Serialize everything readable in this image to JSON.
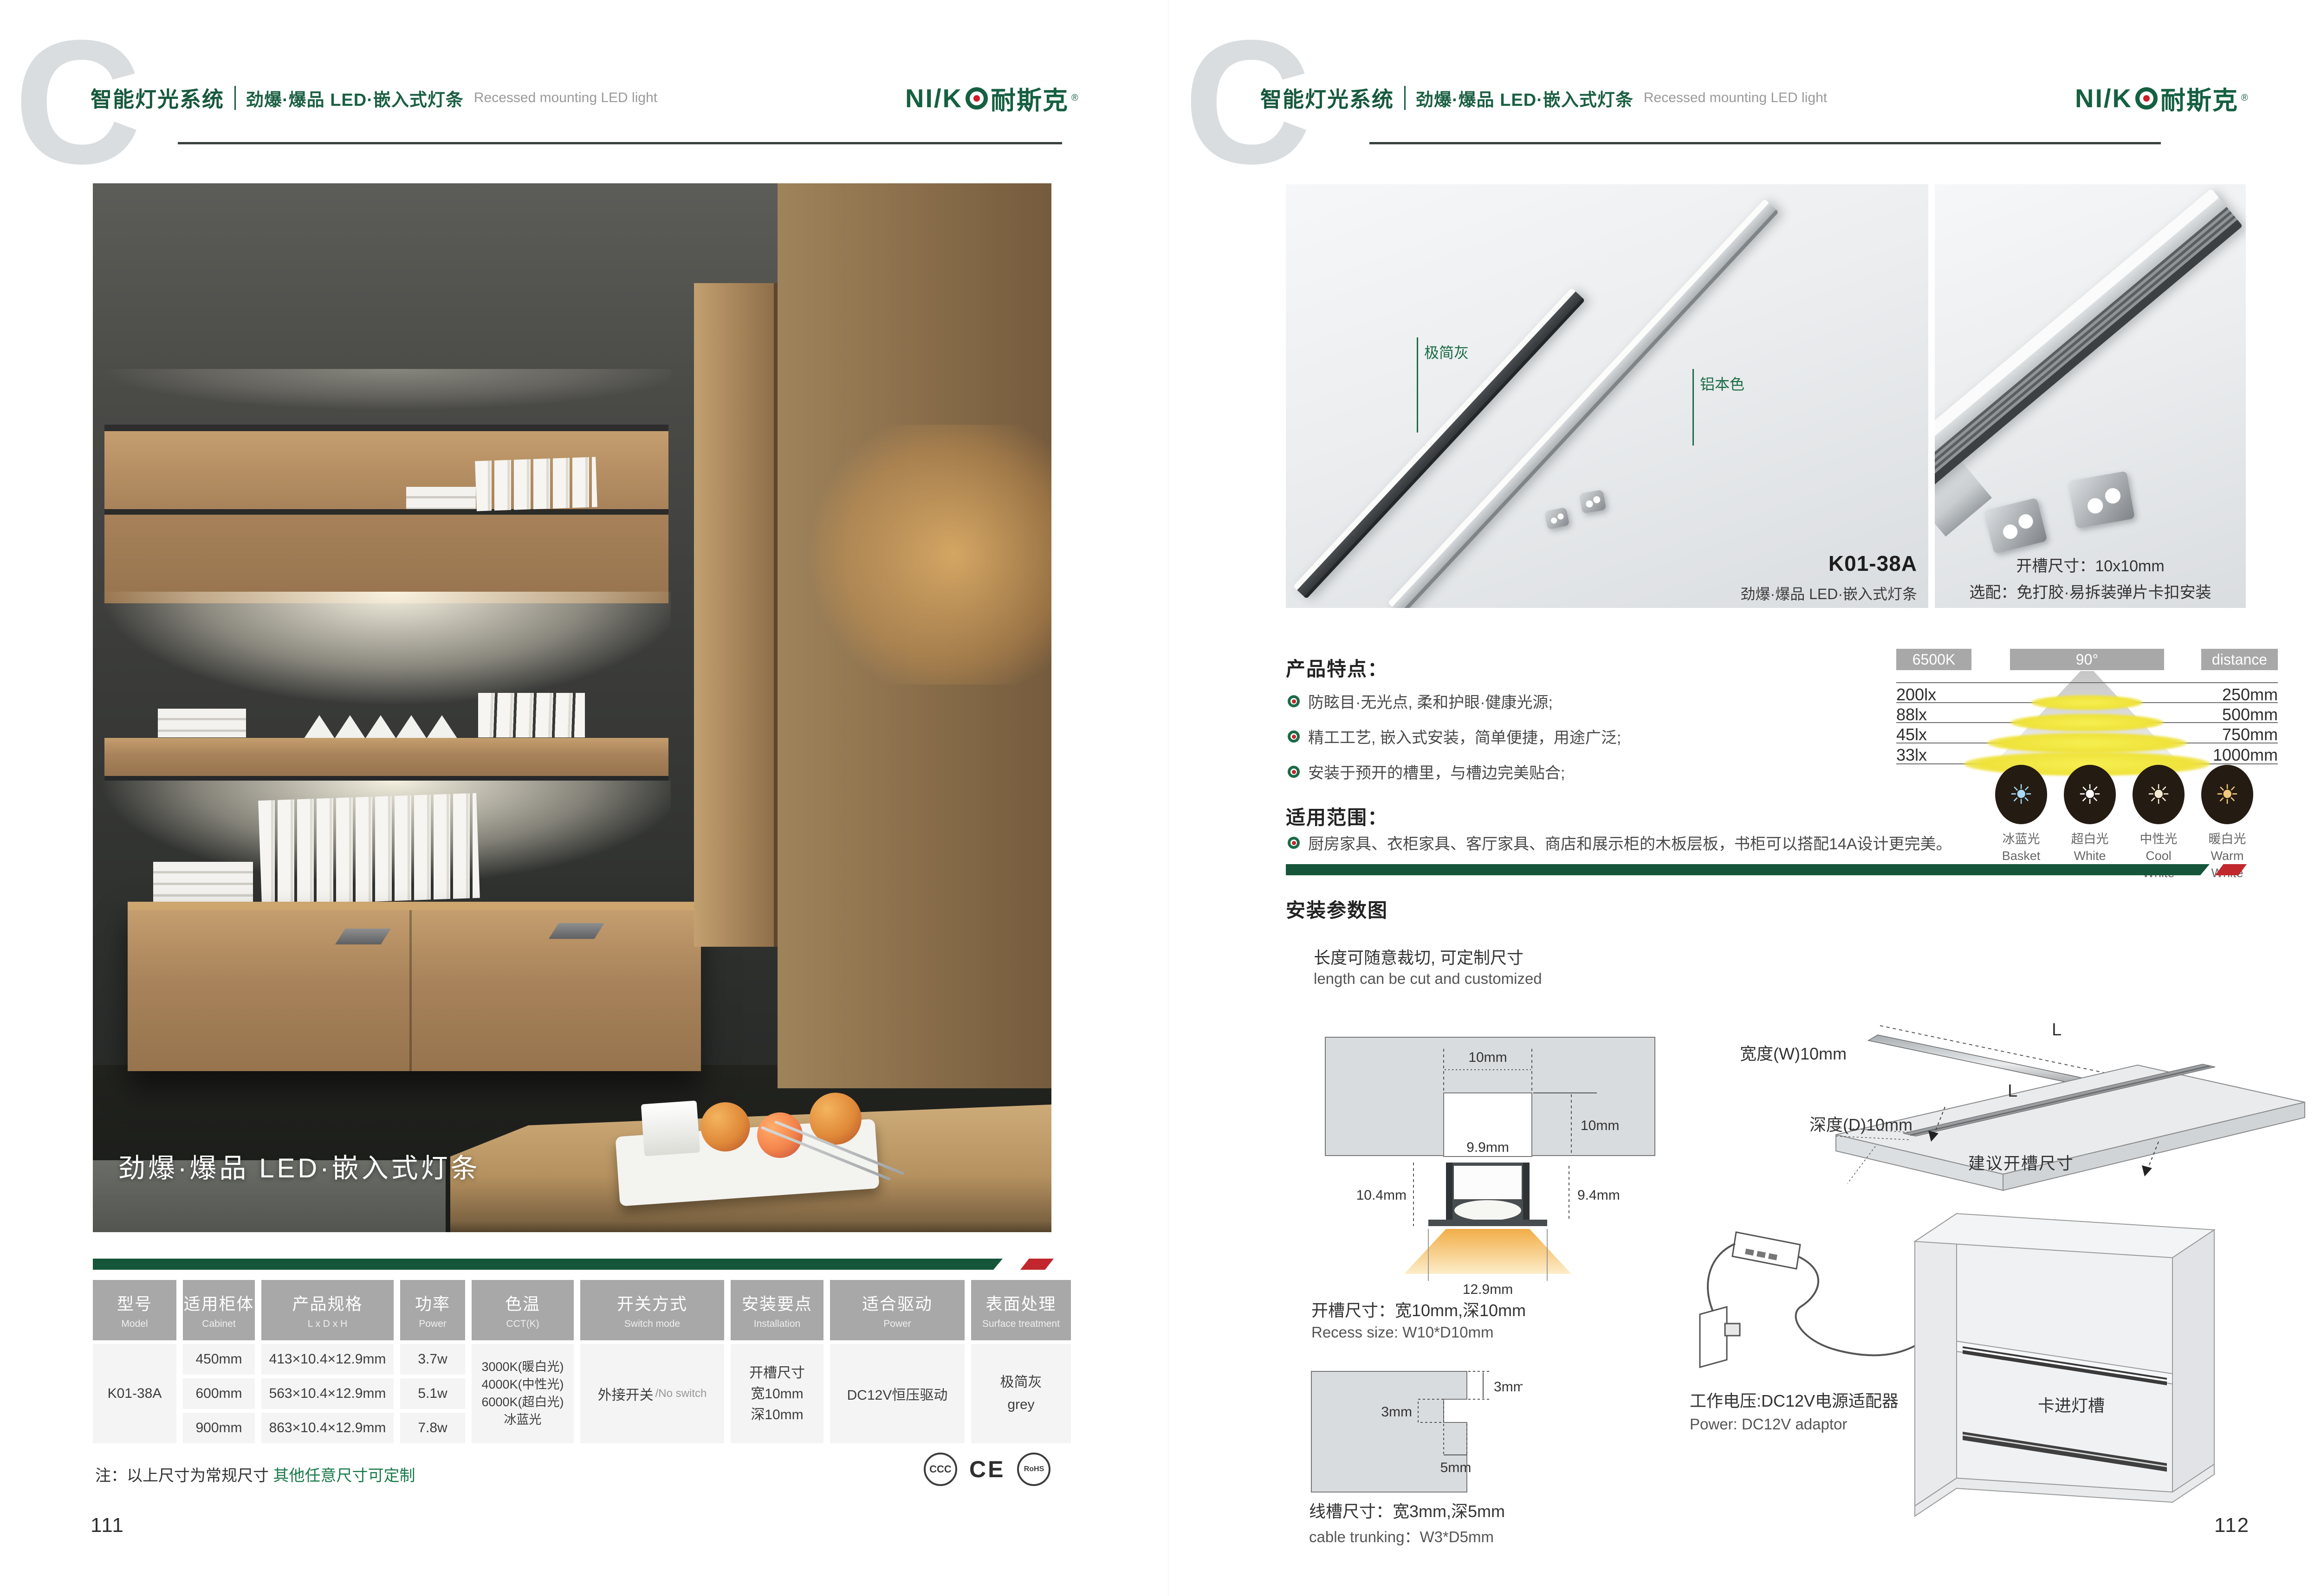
{
  "brand": {
    "latin": "NI/K",
    "cn": "耐斯克",
    "reg": "®"
  },
  "header": {
    "watermark": "C",
    "system": "智能灯光系统",
    "product": "劲爆·爆品  LED·嵌入式灯条",
    "product_en": "Recessed mounting LED light"
  },
  "left_page": {
    "photo_caption": "劲爆·爆品  LED·嵌入式灯条",
    "table": {
      "headers": [
        {
          "cn": "型号",
          "en": "Model"
        },
        {
          "cn": "适用柜体",
          "en": "Cabinet"
        },
        {
          "cn": "产品规格",
          "en": "L x D x H"
        },
        {
          "cn": "功率",
          "en": "Power"
        },
        {
          "cn": "色温",
          "en": "CCT(K)"
        },
        {
          "cn": "开关方式",
          "en": "Switch mode"
        },
        {
          "cn": "安装要点",
          "en": "Installation"
        },
        {
          "cn": "适合驱动",
          "en": "Power"
        },
        {
          "cn": "表面处理",
          "en": "Surface treatment"
        }
      ],
      "model": "K01-38A",
      "rows": [
        {
          "cabinet": "450mm",
          "spec": "413×10.4×12.9mm",
          "power": "3.7w"
        },
        {
          "cabinet": "600mm",
          "spec": "563×10.4×12.9mm",
          "power": "5.1w"
        },
        {
          "cabinet": "900mm",
          "spec": "863×10.4×12.9mm",
          "power": "7.8w"
        }
      ],
      "cct_lines": [
        "3000K(暖白光)",
        "4000K(中性光)",
        "6000K(超白光)",
        "冰蓝光"
      ],
      "switch_cn": "外接开关",
      "switch_en": "/No switch",
      "install_lines": [
        "开槽尺寸",
        "宽10mm",
        "深10mm"
      ],
      "driver": "DC12V恒压驱动",
      "surface_lines": [
        "极简灰",
        "grey"
      ]
    },
    "note_prefix": "注：以上尺寸为常规尺寸 ",
    "note_green": "其他任意尺寸可定制",
    "certs": {
      "ccc": "CCC",
      "ce": "CE",
      "rohs": "RoHS"
    },
    "page_number": "111"
  },
  "right_page": {
    "product_photo": {
      "label_gray": "极简灰",
      "label_aluminum": "铝本色",
      "model": "K01-38A",
      "model_caption": "劲爆·爆品  LED·嵌入式灯条"
    },
    "accessory_photo": {
      "line1": "开槽尺寸：10x10mm",
      "line2": "选配：免打胶·易拆装弹片卡扣安装"
    },
    "features": {
      "title": "产品特点：",
      "items": [
        "防眩目·无光点, 柔和护眼·健康光源;",
        "精工工艺, 嵌入式安装，简单便捷，用途广泛;",
        "安装于预开的槽里，与槽边完美贴合;"
      ]
    },
    "range": {
      "title": "适用范围：",
      "item": "厨房家具、衣柜家具、客厅家具、商店和展示柜的木板层板，书柜可以搭配14A设计更完美。"
    },
    "beam": {
      "cct": "6500K",
      "angle": "90°",
      "distance_label": "distance",
      "rows": [
        {
          "lux": "200lx",
          "mm": "250mm"
        },
        {
          "lux": "88lx",
          "mm": "500mm"
        },
        {
          "lux": "45lx",
          "mm": "750mm"
        },
        {
          "lux": "33lx",
          "mm": "1000mm"
        }
      ]
    },
    "cct_options": [
      {
        "cn": "冰蓝光",
        "en": "Basket",
        "color": "#a9d9f2"
      },
      {
        "cn": "超白光",
        "en": "White",
        "color": "#ffffff"
      },
      {
        "cn": "中性光",
        "en": "Cool White",
        "color": "#f4ead2"
      },
      {
        "cn": "暖白光",
        "en": "Warm White",
        "color": "#f1c97c"
      }
    ],
    "install": {
      "title": "安装参数图",
      "cut_cn": "长度可随意裁切, 可定制尺寸",
      "cut_en": "length can be cut and customized",
      "cross_section": {
        "w_top": "10mm",
        "d_right": "10mm",
        "w_inner": "9.9mm",
        "h_left": "10.4mm",
        "h_right": "9.4mm",
        "w_beam": "12.9mm"
      },
      "recess_cn": "开槽尺寸：宽10mm,深10mm",
      "recess_en": "Recess size: W10*D10mm",
      "trunk": {
        "t_right": "3mm",
        "t_left": "3mm",
        "t_depth": "5mm"
      },
      "trunk_cn": "线槽尺寸：宽3mm,深5mm",
      "trunk_en": "cable trunking：W3*D5mm",
      "board": {
        "l_top": "L",
        "l_groove": "L",
        "width": "宽度(W)10mm",
        "depth": "深度(D)10mm",
        "caption": "建议开槽尺寸"
      },
      "power_cn": "工作电压:DC12V电源适配器",
      "power_en": "Power: DC12V adaptor",
      "clip_label": "卡进灯槽"
    },
    "page_number": "112"
  },
  "colors": {
    "brand_green": "#16593c",
    "accent_red": "#c1272d",
    "table_header": "#a8a8a8"
  }
}
